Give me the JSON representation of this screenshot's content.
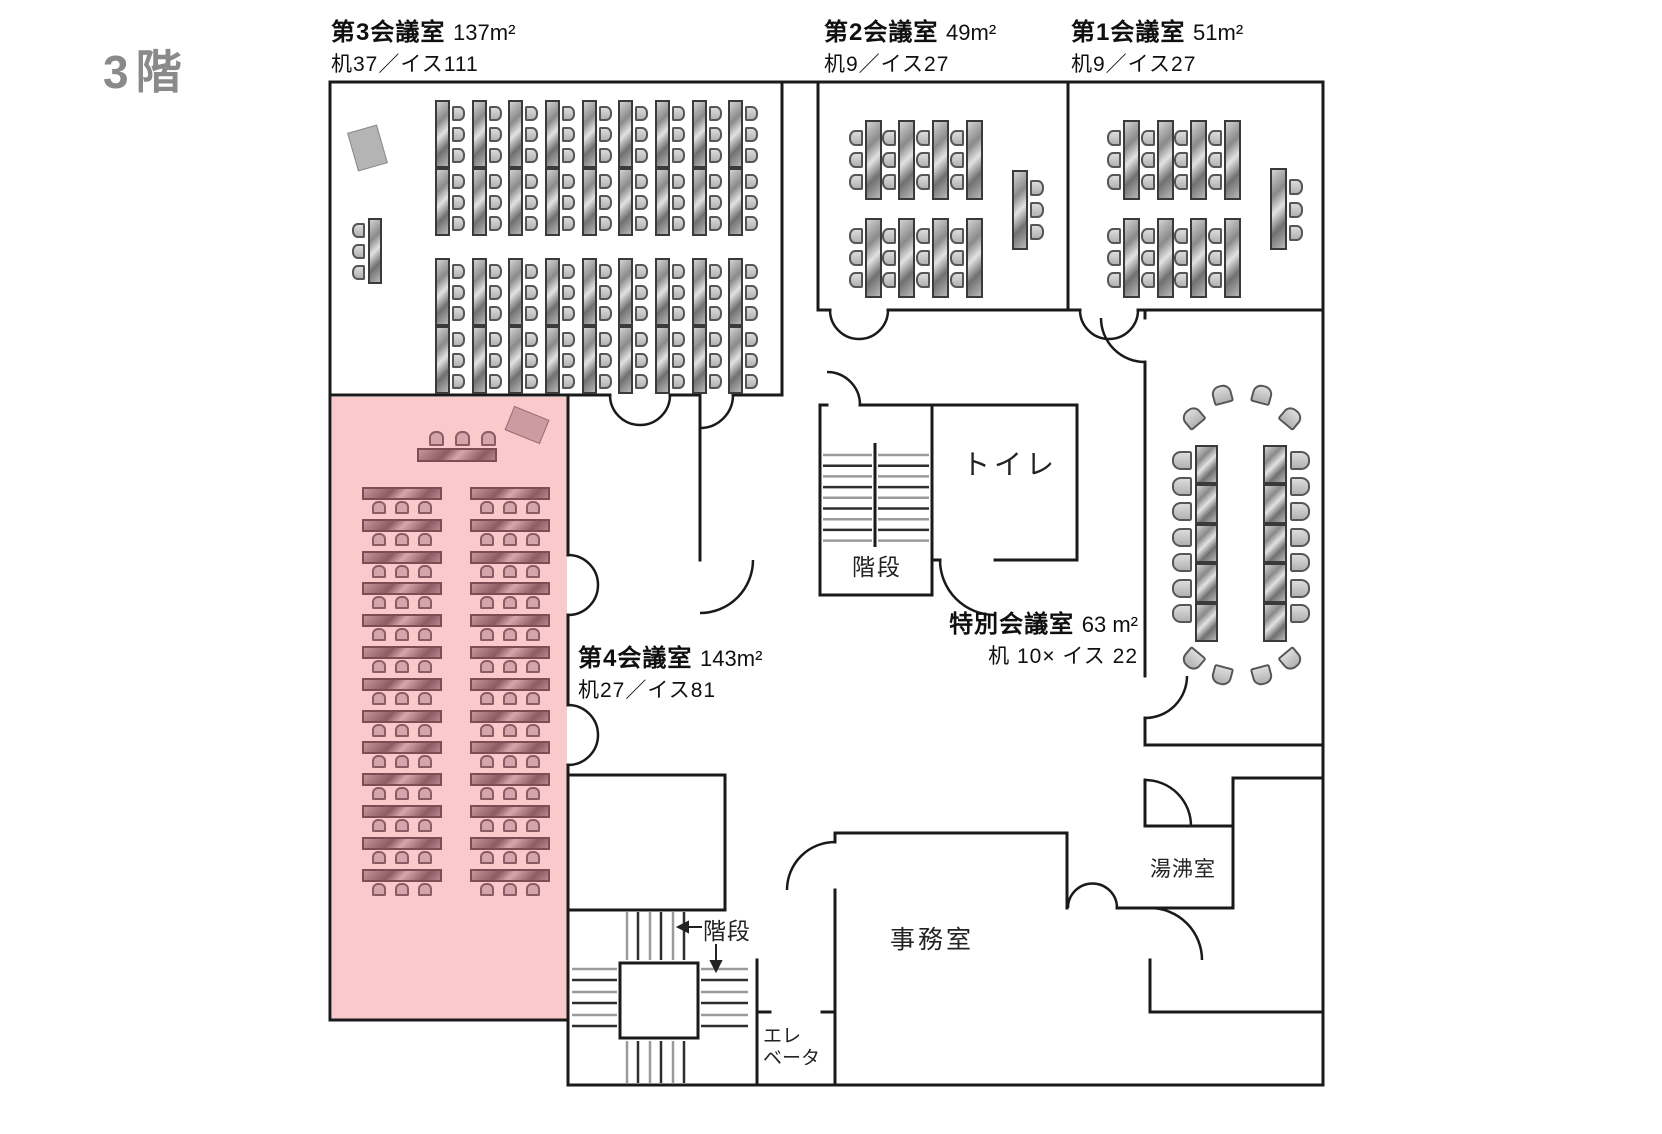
{
  "floor_title": "3階",
  "rooms": [
    {
      "name": "第3会議室",
      "area": "137m²",
      "capacity": "机37／イス111"
    },
    {
      "name": "第2会議室",
      "area": "49m²",
      "capacity": "机9／イス27"
    },
    {
      "name": "第1会議室",
      "area": "51m²",
      "capacity": "机9／イス27"
    },
    {
      "name": "第4会議室",
      "area": "143m²",
      "capacity": "机27／イス81",
      "highlighted": true
    },
    {
      "name": "特別会議室",
      "area": "63 m²",
      "capacity": "机 10× イス 22"
    }
  ],
  "facilities": {
    "toilet": "トイレ",
    "stairs_middle": "階段",
    "stairs_bottom": "階段",
    "elevator_line1": "エレ",
    "elevator_line2": "ベータ",
    "office": "事務室",
    "kitchenette": "湯沸室"
  },
  "colors": {
    "highlighted_room_fill": "#F9C9CC",
    "highlighted_table": "#A8747C",
    "gray_table": "#9E9E9E",
    "wall": "#1A1A1A",
    "floor_title_gray": "#8A8A8A"
  }
}
